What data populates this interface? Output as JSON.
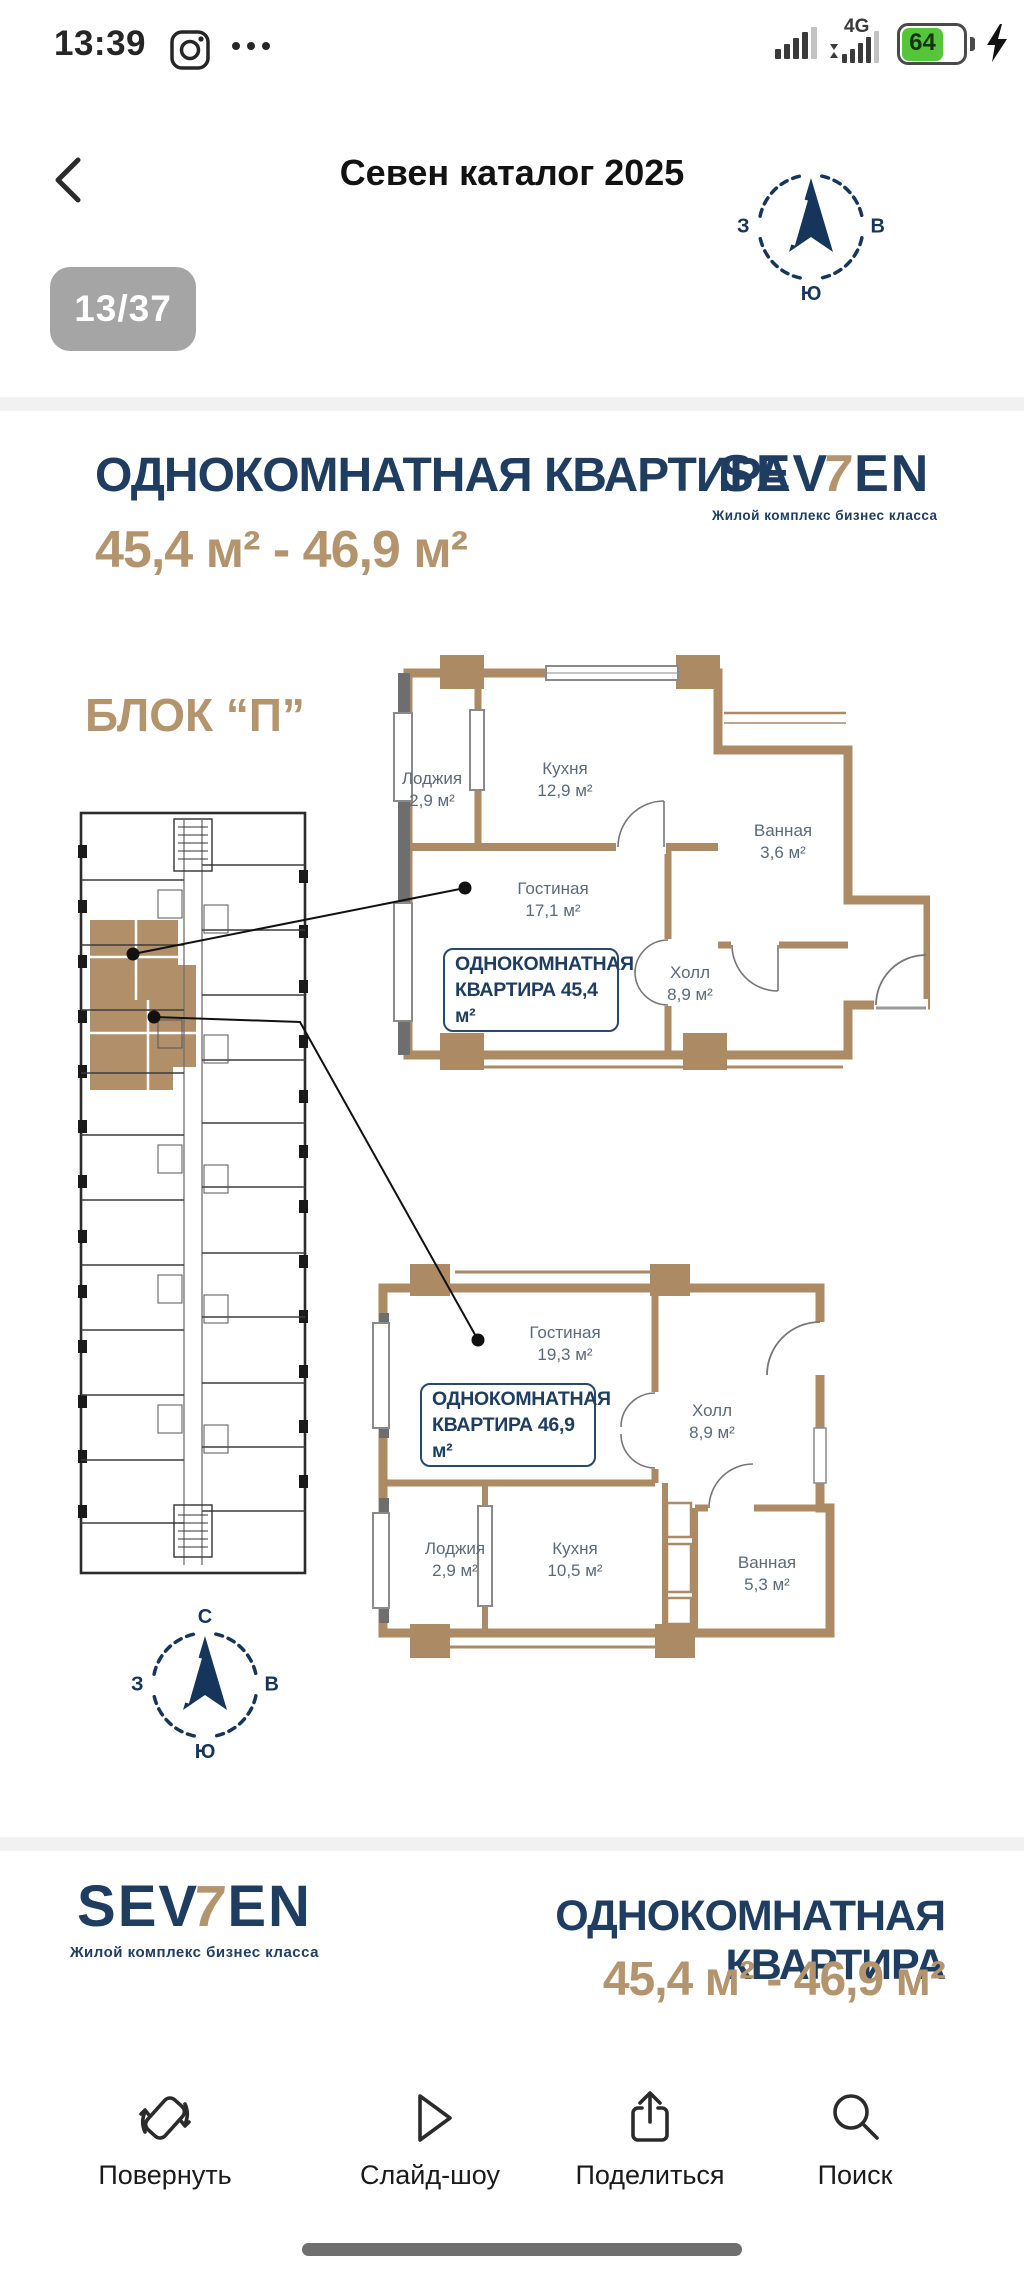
{
  "status_bar": {
    "time": "13:39",
    "network": "4G",
    "battery_level": "64"
  },
  "nav": {
    "title": "Севен каталог 2025",
    "page_indicator": "13/37"
  },
  "brand": {
    "se": "SE",
    "v": "V",
    "seven": "7",
    "en": "EN",
    "tagline": "Жилой комплекс бизнес класса"
  },
  "compass": {
    "north": "С",
    "east": "В",
    "south": "Ю",
    "west": "З"
  },
  "page": {
    "title": "ОДНОКОМНАТНАЯ КВАРТИРА",
    "area_range": "45,4 м² - 46,9 м²",
    "block_label": "БЛОК “П”",
    "apartments": [
      {
        "tag_line1": "ОДНОКОМНАТНАЯ",
        "tag_line2": "КВАРТИРА 45,4 м²",
        "rooms": [
          {
            "name": "Лоджия",
            "area": "2,9 м²"
          },
          {
            "name": "Кухня",
            "area": "12,9 м²"
          },
          {
            "name": "Гостиная",
            "area": "17,1 м²"
          },
          {
            "name": "Ванная",
            "area": "3,6 м²"
          },
          {
            "name": "Холл",
            "area": "8,9 м²"
          }
        ]
      },
      {
        "tag_line1": "ОДНОКОМНАТНАЯ",
        "tag_line2": "КВАРТИРА 46,9 м²",
        "rooms": [
          {
            "name": "Гостиная",
            "area": "19,3 м²"
          },
          {
            "name": "Холл",
            "area": "8,9 м²"
          },
          {
            "name": "Лоджия",
            "area": "2,9 м²"
          },
          {
            "name": "Кухня",
            "area": "10,5 м²"
          },
          {
            "name": "Ванная",
            "area": "5,3 м²"
          }
        ]
      }
    ]
  },
  "footer_page": {
    "title": "ОДНОКОМНАТНАЯ КВАРТИРА",
    "area_range": "45,4 м² - 46,9 м²"
  },
  "toolbar": {
    "items": [
      {
        "label": "Повернуть"
      },
      {
        "label": "Слайд-шоу"
      },
      {
        "label": "Поделиться"
      },
      {
        "label": "Поиск"
      }
    ]
  },
  "colors": {
    "navy": "#1e3d60",
    "tan_wall": "#ab8a64",
    "tan_text": "#b3946d",
    "battery_green": "#55c63a"
  }
}
